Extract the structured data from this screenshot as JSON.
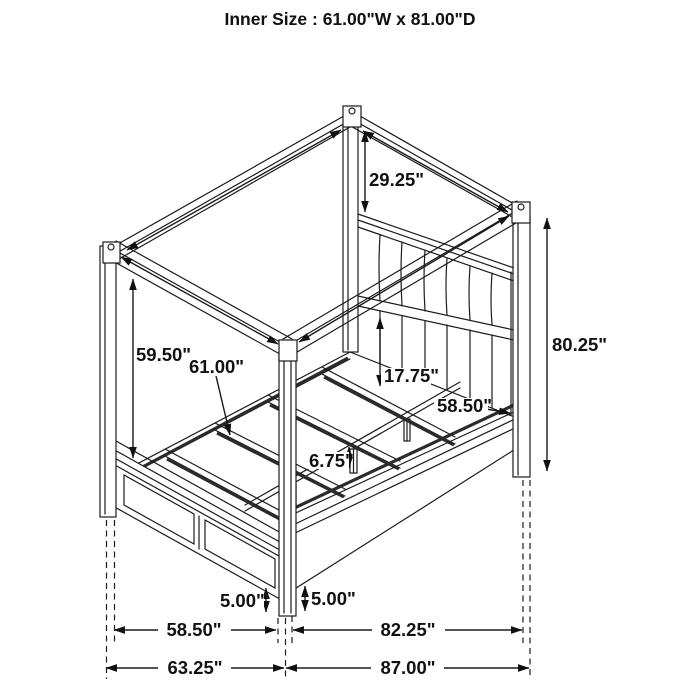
{
  "title": "Inner Size : 61.00\"W x 81.00\"D",
  "dims": {
    "canopy_to_headboard": "29.25\"",
    "headboard_post_height": "80.25\"",
    "canopy_clearance": "59.50\"",
    "slat_length": "61.00\"",
    "headboard_panel_clearance": "17.75\"",
    "frame_inner_width": "58.50\"",
    "center_support_leg_height": "6.75\"",
    "footboard_floor_clearance": "5.00\"",
    "side_rail_floor_clearance": "5.00\"",
    "footboard_span": "58.50\"",
    "side_rail_span": "82.25\"",
    "overall_width": "63.25\"",
    "overall_length": "87.00\""
  }
}
